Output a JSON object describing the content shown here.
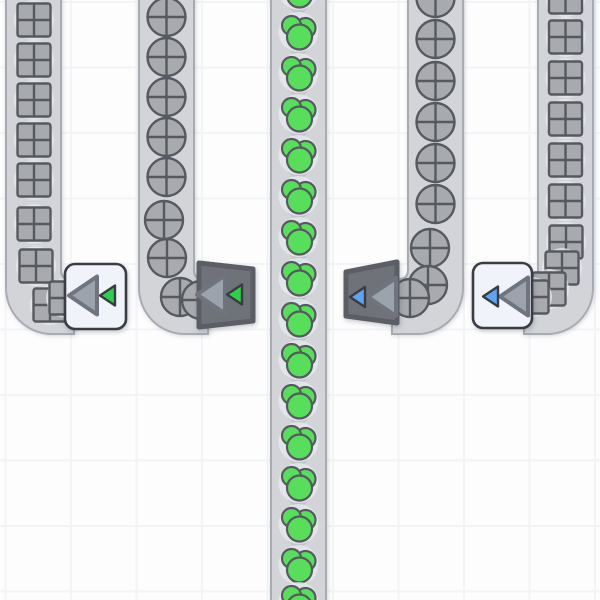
{
  "meta": {
    "app": "factory-conveyor-game",
    "view": "top-down-factory-grid",
    "canvas_width": 600,
    "canvas_height": 600
  },
  "palette": {
    "background": "#fdfdfe",
    "grid_line": "#f3f4f6",
    "belt_fill": "#d2d4d8",
    "belt_edge": "#a8abb1",
    "belt_arrow": "#c2c5ca",
    "shape_fill": "#a8aaae",
    "shape_outline": "#56595f",
    "item_halo": "rgba(232,235,240,0.75)",
    "paint_green": "#57df5b",
    "building_light_fill": "#f0f3fa",
    "building_light_border": "#3a3d43",
    "building_dark_fill": "#6f7379",
    "building_dark_border": "#5b5f65",
    "arrow_fill": "#9da3ad",
    "arrow_border": "#6f747e",
    "tier_green": "#2bd14b",
    "tier_blue": "#5ea4f2",
    "tier_border": "#393c42"
  },
  "layout": {
    "grid_size": 65.5,
    "grid_offset_x": 4.5,
    "grid_offset_y": 1,
    "band_top": 279,
    "band_bottom": 334,
    "outer_radius": 46,
    "inner_radius": 9,
    "square_size": 33,
    "circle_radius": 19,
    "halo_radius": 20,
    "chevron_half_width": 14,
    "chevron_half_height": 7,
    "chevron_offset": 20.5,
    "big_arrow_width": 28,
    "big_arrow_height": 38,
    "tier_arrow_width": 15,
    "tier_arrow_height": 20
  },
  "item_types": {
    "square": "uncolored-quartered-square-shape",
    "circle": "uncolored-quartered-circle-shape",
    "paint": "green-paint-blob"
  },
  "paint_blob_circles": [
    {
      "dx": 7,
      "dy": -4,
      "r": 10
    },
    {
      "dx": -7,
      "dy": -6.5,
      "r": 9.5
    },
    {
      "dx": 1,
      "dy": 5,
      "r": 12.5
    }
  ],
  "belts": [
    {
      "id": "belt-outer-left",
      "item": "square",
      "kind": "curve-east",
      "x0": 6,
      "x1": 61,
      "cx": 34,
      "end_x": 74,
      "item_ys": [
        20,
        60,
        100,
        140,
        180
      ],
      "curve_items": [
        [
          34,
          224
        ],
        [
          36,
          266
        ],
        [
          50,
          305
        ],
        [
          66,
          298
        ]
      ],
      "chevrons": false
    },
    {
      "id": "belt-inner-left",
      "item": "circle",
      "kind": "curve-east",
      "x0": 139,
      "x1": 194,
      "cx": 166.5,
      "end_x": 208,
      "item_ys": [
        17,
        57,
        97,
        137,
        177
      ],
      "curve_items": [
        [
          164,
          220
        ],
        [
          167,
          258
        ],
        [
          180,
          297
        ],
        [
          201,
          300
        ]
      ],
      "chevrons": false
    },
    {
      "id": "belt-center",
      "item": "paint",
      "kind": "straight",
      "x0": 271,
      "x1": 326,
      "cx": 298.5,
      "end_x": null,
      "item_ys": [
        -10,
        32,
        73,
        114,
        155,
        196,
        237,
        278,
        319,
        360,
        401,
        442,
        483,
        524,
        565,
        602
      ],
      "curve_items": [],
      "chevrons": true
    },
    {
      "id": "belt-inner-right",
      "item": "circle",
      "kind": "curve-west",
      "x0": 408,
      "x1": 463,
      "cx": 435.5,
      "end_x": 392,
      "item_ys": [
        -2,
        39,
        81,
        122,
        163,
        204
      ],
      "curve_items": [
        [
          430,
          248
        ],
        [
          428,
          285
        ],
        [
          410,
          298
        ]
      ],
      "chevrons": false
    },
    {
      "id": "belt-outer-right",
      "item": "square",
      "kind": "curve-west",
      "x0": 538,
      "x1": 593,
      "cx": 565.5,
      "end_x": 524,
      "item_ys": [
        -3,
        37,
        78,
        119,
        160,
        201
      ],
      "curve_items": [
        [
          566,
          242
        ],
        [
          562,
          268
        ],
        [
          549,
          289
        ],
        [
          532,
          297
        ]
      ],
      "chevrons": false
    }
  ],
  "buildings": [
    {
      "id": "tunnel-tier1-exit-left",
      "variant": "light",
      "tier": "I",
      "tier_color": "green",
      "rect": [
        65,
        264,
        61,
        65
      ],
      "pts": null,
      "big_apex_x": 69,
      "small_apex_x": 100,
      "cy": 295.5,
      "arrow_dir": "left"
    },
    {
      "id": "tunnel-tier1-entrance-left",
      "variant": "dark",
      "tier": "I",
      "tier_color": "green",
      "rect": null,
      "pts": [
        [
          199,
          263
        ],
        [
          253,
          269
        ],
        [
          253,
          321
        ],
        [
          199,
          327
        ]
      ],
      "big_apex_x": 197,
      "small_apex_x": 227,
      "cy": 294.5,
      "arrow_dir": "left"
    },
    {
      "id": "tunnel-tier2-entrance-right",
      "variant": "dark",
      "tier": "II",
      "tier_color": "blue",
      "rect": null,
      "pts": [
        [
          346,
          272
        ],
        [
          397,
          262
        ],
        [
          397,
          323
        ],
        [
          346,
          316
        ]
      ],
      "big_apex_x": 368,
      "small_apex_x": 350,
      "cy": 297,
      "arrow_dir": "left"
    },
    {
      "id": "tunnel-tier2-exit-right",
      "variant": "light",
      "tier": "II",
      "tier_color": "blue",
      "rect": [
        473,
        263,
        59,
        65
      ],
      "pts": null,
      "big_apex_x": 500,
      "small_apex_x": 483,
      "cy": 296.5,
      "arrow_dir": "left"
    }
  ]
}
